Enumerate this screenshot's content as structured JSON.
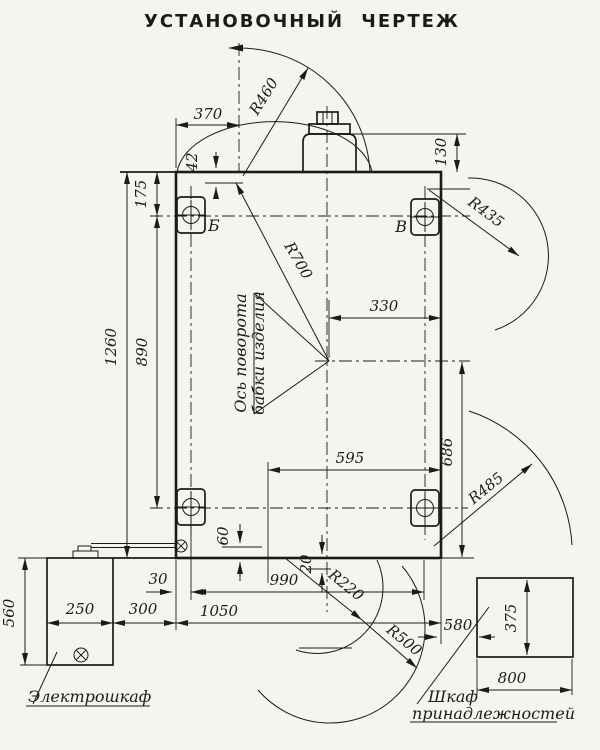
{
  "title": "УСТАНОВОЧНЫЙ  ЧЕРТЕЖ",
  "dims": {
    "d370": "370",
    "d42": "42",
    "d130": "130",
    "d175": "175",
    "d890": "890",
    "d1260": "1260",
    "d330": "330",
    "d595": "595",
    "d686": "686",
    "d60": "60",
    "d20": "20",
    "d30": "30",
    "d990": "990",
    "d1050": "1050",
    "d300": "300",
    "d250": "250",
    "d560": "560",
    "d580": "580",
    "d375": "375",
    "d800": "800"
  },
  "radii": {
    "r460": "R460",
    "r700": "R700",
    "r435": "R435",
    "r485": "R485",
    "r220": "R220",
    "r500": "R500"
  },
  "holes": {
    "top_left": "Б",
    "top_right": "В"
  },
  "callouts": {
    "pivot_line1": "Ось поворота",
    "pivot_line2": "бабки изделия",
    "electrical_cabinet": "Электрошкаф",
    "accessory_line1": "Шкаф",
    "accessory_line2": "принадлежностей"
  },
  "colors": {
    "ink": "#1b1b1b",
    "paper": "#f5f4ef"
  }
}
